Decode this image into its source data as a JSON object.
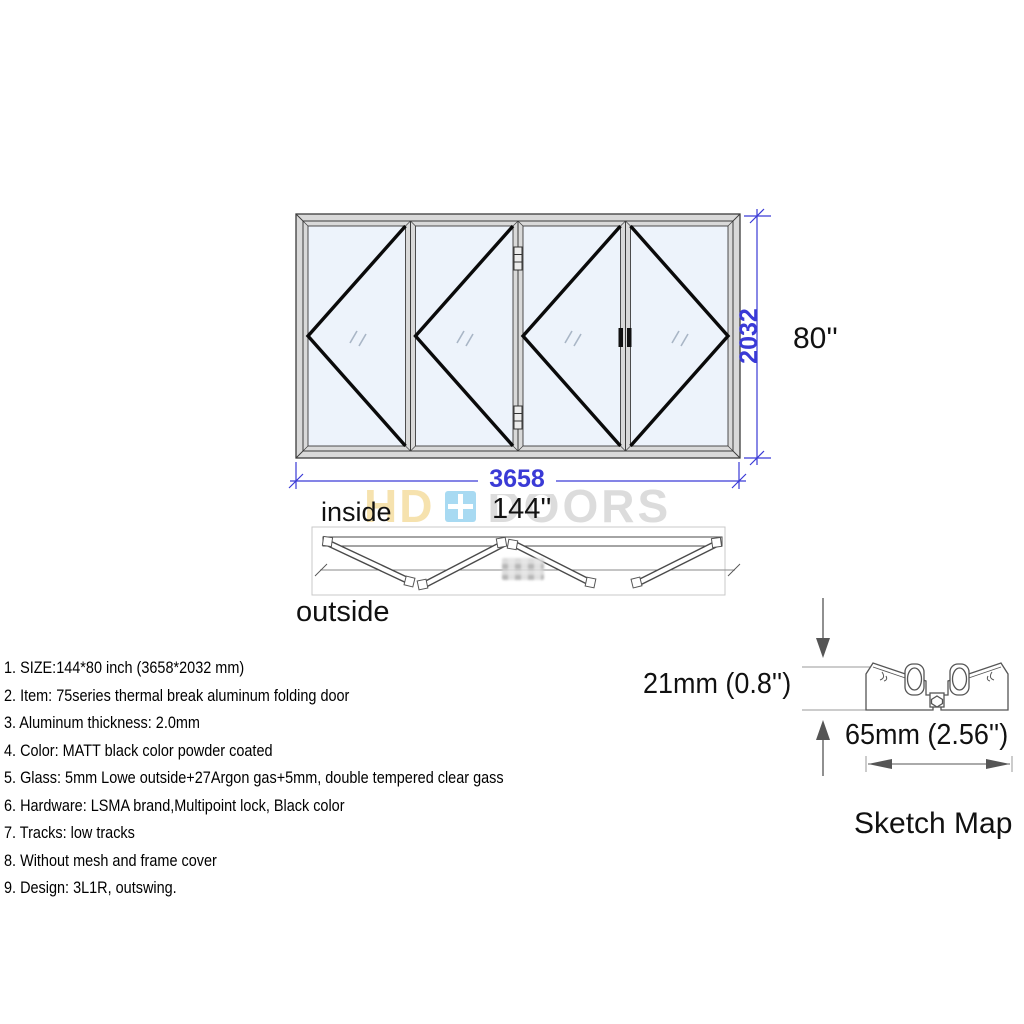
{
  "front_view": {
    "width_mm": "3658",
    "height_mm": "2032",
    "width_in": "144''",
    "height_in": "80''",
    "inside_label": "inside",
    "outside_label": "outside"
  },
  "watermark": {
    "left_text": "HD",
    "right_text": "DOORS"
  },
  "specs": {
    "items": [
      "1. SIZE:144*80 inch (3658*2032 mm)",
      "2. Item: 75series thermal break aluminum folding door",
      "3. Aluminum thickness: 2.0mm",
      "4. Color: MATT black color powder coated",
      "5. Glass: 5mm Lowe outside+27Argon gas+5mm, double tempered clear gass",
      "6. Hardware: LSMA brand,Multipoint lock, Black color",
      "7. Tracks: low tracks",
      "8. Without mesh and frame cover",
      "9. Design: 3L1R, outswing."
    ]
  },
  "sketch_map": {
    "height_label": "21mm (0.8'')",
    "width_label": "65mm (2.56'')",
    "title": "Sketch Map"
  },
  "colors": {
    "dimension_blue": "#3a3ad6",
    "glass_blue": "#edf3fb",
    "frame_gray": "#d9d9d9",
    "chevron_black": "#0a0a0a",
    "watermark_hd": "#f6e2ae",
    "watermark_doors": "#dcdcdc",
    "watermark_icon_blue": "#a8daf2"
  }
}
